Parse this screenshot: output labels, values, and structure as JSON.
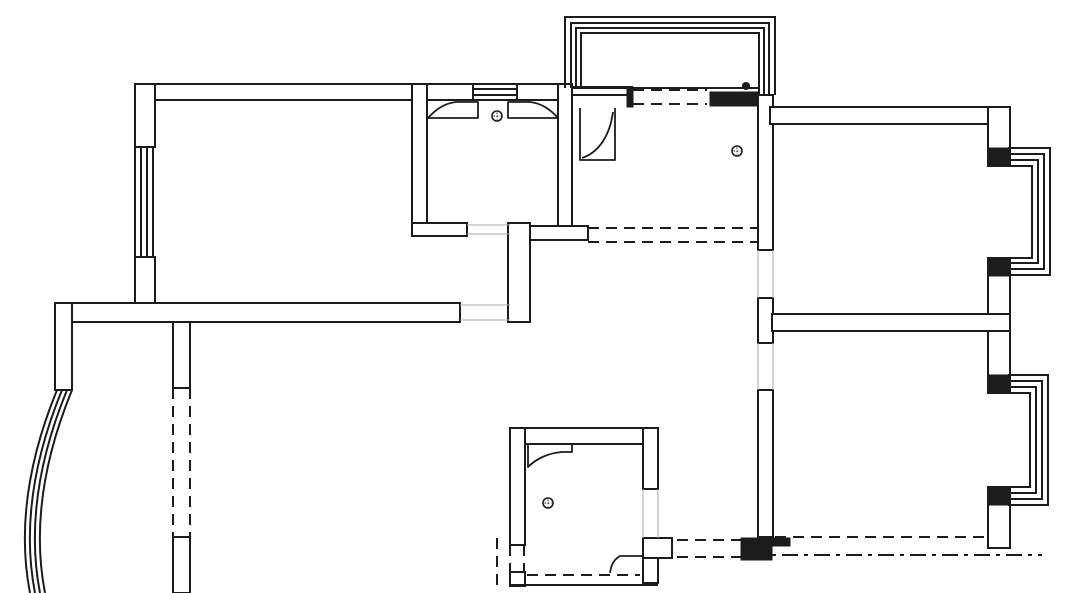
{
  "app": {
    "title": "apartment-floor-plan-drawing"
  },
  "canvas": {
    "width": 1080,
    "height": 593,
    "background": "#ffffff"
  },
  "styles": {
    "line_color": "#1c1c1c",
    "wall_fill": "#ffffff",
    "thin_color": "#a8a8a8",
    "wall_stroke_width": 2,
    "line_stroke_width": 2,
    "door_stroke_width": 1.8,
    "thin_stroke_width": 1,
    "dash_pattern": "11 7",
    "dashdot_pattern": "16 6 4 6"
  },
  "plan": {
    "wall_rects": [
      {
        "name": "wall-top-left",
        "d": "M135,84 H473 V100 H135 Z"
      },
      {
        "name": "wall-top-right-of-window",
        "d": "M517,84 H558 V100 H517 Z"
      },
      {
        "name": "wall-left-upper",
        "d": "M135,84 H155 V147 H135 Z"
      },
      {
        "name": "wall-left-lower",
        "d": "M135,257 H155 V303 H135 Z"
      },
      {
        "name": "wall-hall-band",
        "d": "M55,303 H460 V322 H55 Z"
      },
      {
        "name": "wall-hall-connector-vertical",
        "d": "M508,223 H530 V322 H508 Z"
      },
      {
        "name": "wall-bath1-left",
        "d": "M412,84 H427 V236 H412 Z"
      },
      {
        "name": "wall-bath1-bottom",
        "d": "M412,223 H467 V236 H412 Z"
      },
      {
        "name": "wall-bath1-right",
        "d": "M558,84 H572 V240 H558 Z"
      },
      {
        "name": "wall-kitchen-top-left",
        "d": "M572,87 H632 V95 H572 Z"
      },
      {
        "name": "wall-hall-connector-horizontal",
        "d": "M530,226 H588 V240 H530 Z"
      },
      {
        "name": "wall-balcony-post-left",
        "d": "M55,303 H72 V390 H55 Z"
      },
      {
        "name": "wall-dining-divider-upper",
        "d": "M173,322 H190 V388 H173 Z"
      },
      {
        "name": "wall-dining-divider-lower",
        "d": "M173,537 H190 V593 H173 Z"
      },
      {
        "name": "wall-right-zone-left-a",
        "d": "M758,95 H773 V250 H758 Z"
      },
      {
        "name": "wall-right-zone-left-b",
        "d": "M758,298 H773 V343 H758 Z"
      },
      {
        "name": "wall-right-zone-left-c",
        "d": "M758,390 H773 V537 H758 Z"
      },
      {
        "name": "wall-bedroom1-top",
        "d": "M770,107 H1010 V124 H770 Z"
      },
      {
        "name": "wall-right-outer-upper",
        "d": "M988,107 H1010 V166 H988 Z"
      },
      {
        "name": "wall-right-outer-middle",
        "d": "M988,258 H1010 V393 H988 Z"
      },
      {
        "name": "wall-right-outer-lower",
        "d": "M988,487 H1010 V548 H988 Z"
      },
      {
        "name": "wall-between-bedrooms",
        "d": "M772,314 H1010 V331 H772 Z"
      },
      {
        "name": "wall-bath2-top",
        "d": "M510,428 H658 V444 H510 Z"
      },
      {
        "name": "wall-bath2-left-upper",
        "d": "M510,428 H525 V545 H510 Z"
      },
      {
        "name": "wall-bath2-left-corner",
        "d": "M510,572 H525 V586 H510 Z"
      },
      {
        "name": "wall-bath2-right-upper",
        "d": "M643,428 H658 V489 H643 Z"
      },
      {
        "name": "wall-bath2-jog",
        "d": "M643,538 H672 V558 H643 Z"
      },
      {
        "name": "wall-bath2-right-lower",
        "d": "M643,558 H658 V583 H643 Z"
      }
    ],
    "filled_walls": [
      {
        "name": "wall-stub-balcony-left-cap",
        "d": "M627,87 H633 V107 H627 Z"
      },
      {
        "name": "wall-stub-balcony-right-bar",
        "d": "M710,92 H758 V106 H710 Z"
      },
      {
        "name": "wall-stub-bay1-top",
        "d": "M988,148 H1010 V166 H988 Z"
      },
      {
        "name": "wall-stub-bay1-bottom",
        "d": "M988,258 H1010 V276 H988 Z"
      },
      {
        "name": "wall-stub-bay2-top",
        "d": "M988,375 H1010 V393 H988 Z"
      },
      {
        "name": "wall-stub-bay2-bottom",
        "d": "M988,487 H1010 V505 H988 Z"
      },
      {
        "name": "wall-corner-bedroom2-bottom-left",
        "d": "M741,538 H772 V560 H741 Z"
      },
      {
        "name": "wall-stub-bedroom2-bottom",
        "d": "M772,538 H790 V546 H772 Z"
      }
    ],
    "lines": [
      {
        "name": "balcony-top-frame-line-1",
        "d": "M565,88 V17 H775 V95"
      },
      {
        "name": "balcony-top-frame-line-2",
        "d": "M571,88 V23 H769 V95"
      },
      {
        "name": "balcony-top-frame-line-3",
        "d": "M576,88 V28 H764 V95"
      },
      {
        "name": "balcony-top-frame-line-4",
        "d": "M581,88 V33 H759 V95"
      },
      {
        "name": "balcony-top-sill-line",
        "d": "M572,88 H758"
      },
      {
        "name": "window-top-wall-line-1",
        "d": "M473,84 H517"
      },
      {
        "name": "window-top-wall-line-2",
        "d": "M473,89 H517"
      },
      {
        "name": "window-top-wall-line-3",
        "d": "M473,95 H517"
      },
      {
        "name": "window-top-wall-line-4",
        "d": "M473,100 H517"
      },
      {
        "name": "window-left-wall-line-1",
        "d": "M135,147 V257"
      },
      {
        "name": "window-left-wall-line-2",
        "d": "M141,147 V257"
      },
      {
        "name": "window-left-wall-line-3",
        "d": "M147,147 V257"
      },
      {
        "name": "window-left-wall-line-4",
        "d": "M153,147 V257"
      },
      {
        "name": "bay-window-top-right-line-1",
        "d": "M1008,148 H1050 V275 H1008"
      },
      {
        "name": "bay-window-top-right-line-2",
        "d": "M1008,154 H1044 V269 H1008"
      },
      {
        "name": "bay-window-top-right-line-3",
        "d": "M1008,160 H1038 V263 H1008"
      },
      {
        "name": "bay-window-top-right-line-4",
        "d": "M1008,166 H1032 V258 H1008"
      },
      {
        "name": "bay-window-bottom-right-line-1",
        "d": "M1008,375 H1048 V505 H1008"
      },
      {
        "name": "bay-window-bottom-right-line-2",
        "d": "M1008,381 H1042 V499 H1008"
      },
      {
        "name": "bay-window-bottom-right-line-3",
        "d": "M1008,387 H1036 V493 H1008"
      },
      {
        "name": "bay-window-bottom-right-line-4",
        "d": "M1008,393 H1030 V487 H1008"
      },
      {
        "name": "bath2-bottom-outer-line",
        "d": "M510,585 H658"
      },
      {
        "name": "curved-balcony-window-line-1",
        "d": "M57,390 Q12,500 30,593"
      },
      {
        "name": "curved-balcony-window-line-2",
        "d": "M62,390 Q17,500 35,593"
      },
      {
        "name": "curved-balcony-window-line-3",
        "d": "M67,390 Q22,500 40,593"
      },
      {
        "name": "curved-balcony-window-line-4",
        "d": "M72,390 Q27,500 45,593"
      }
    ],
    "doors": [
      {
        "name": "door-leaf-bath1-left",
        "d": "M428,118 H478 V102 H456 C446,103 436,109 428,118 Z"
      },
      {
        "name": "door-leaf-bath1-right",
        "d": "M558,118 H508 V102 H530 C540,103 550,109 558,118 Z"
      },
      {
        "name": "door-kitchen-frame",
        "d": "M580,108 V160 H615 V108"
      },
      {
        "name": "door-kitchen-swing",
        "d": "M582,158 C600,152 610,134 613,112"
      },
      {
        "name": "door-leaf-bath2-top",
        "d": "M528,467 V444 H572 V452 H562 C548,453 536,459 528,467 Z"
      },
      {
        "name": "door-leaf-bath2-bottom",
        "d": "M643,548 V556 H620 C613,560 611,566 610,573"
      }
    ],
    "thin_lines": [
      {
        "name": "opening-hall-band-top",
        "d": "M460,305 H510"
      },
      {
        "name": "opening-hall-band-bottom",
        "d": "M460,320 H510"
      },
      {
        "name": "opening-bath1-door-top",
        "d": "M467,225 H510"
      },
      {
        "name": "opening-bath1-door-bottom",
        "d": "M467,234 H510"
      },
      {
        "name": "opening-bedroom1-door-left",
        "d": "M758,250 V298"
      },
      {
        "name": "opening-bedroom1-door-right",
        "d": "M773,250 V298"
      },
      {
        "name": "opening-bedroom2-door-left",
        "d": "M758,343 V390"
      },
      {
        "name": "opening-bedroom2-door-right",
        "d": "M773,343 V390"
      },
      {
        "name": "opening-bath2-door-left",
        "d": "M643,489 V538"
      },
      {
        "name": "opening-bath2-door-right",
        "d": "M658,489 V538"
      }
    ],
    "dashed_lines": [
      {
        "name": "dashed-balcony-opening-top",
        "d": "M633,90 H707"
      },
      {
        "name": "dashed-balcony-opening-bottom",
        "d": "M633,104 H707"
      },
      {
        "name": "dashed-kitchen-south-top",
        "d": "M588,228 H758"
      },
      {
        "name": "dashed-kitchen-south-bottom",
        "d": "M588,242 H758"
      },
      {
        "name": "dashed-dining-divider-left",
        "d": "M173,388 V537"
      },
      {
        "name": "dashed-dining-divider-right",
        "d": "M190,388 V537"
      },
      {
        "name": "dashed-bedroom2-bottom-inner",
        "d": "M775,537 H985"
      },
      {
        "name": "dashed-bedroom2-bottom-outer",
        "d": "M750,555 H1042",
        "pattern": "dashdot"
      },
      {
        "name": "dashed-passage-top",
        "d": "M677,540 H741"
      },
      {
        "name": "dashed-passage-bottom",
        "d": "M677,557 H741"
      },
      {
        "name": "dashed-bath2-bottom-inner",
        "d": "M527,575 H640"
      },
      {
        "name": "dashed-bath2-left-line-1",
        "d": "M510,545 V572"
      },
      {
        "name": "dashed-bath2-left-line-2",
        "d": "M524,545 V572"
      },
      {
        "name": "dashed-bath2-outside-left",
        "d": "M497,538 V586"
      }
    ],
    "symbols": {
      "floor_drains": [
        {
          "name": "floor-drain-bath1",
          "x": 497,
          "y": 116,
          "r": 5
        },
        {
          "name": "floor-drain-kitchen",
          "x": 737,
          "y": 151,
          "r": 5
        },
        {
          "name": "floor-drain-bath2",
          "x": 548,
          "y": 503,
          "r": 5
        }
      ],
      "column_dot": {
        "name": "column-dot-balcony",
        "x": 746,
        "y": 86,
        "r": 4
      }
    }
  }
}
